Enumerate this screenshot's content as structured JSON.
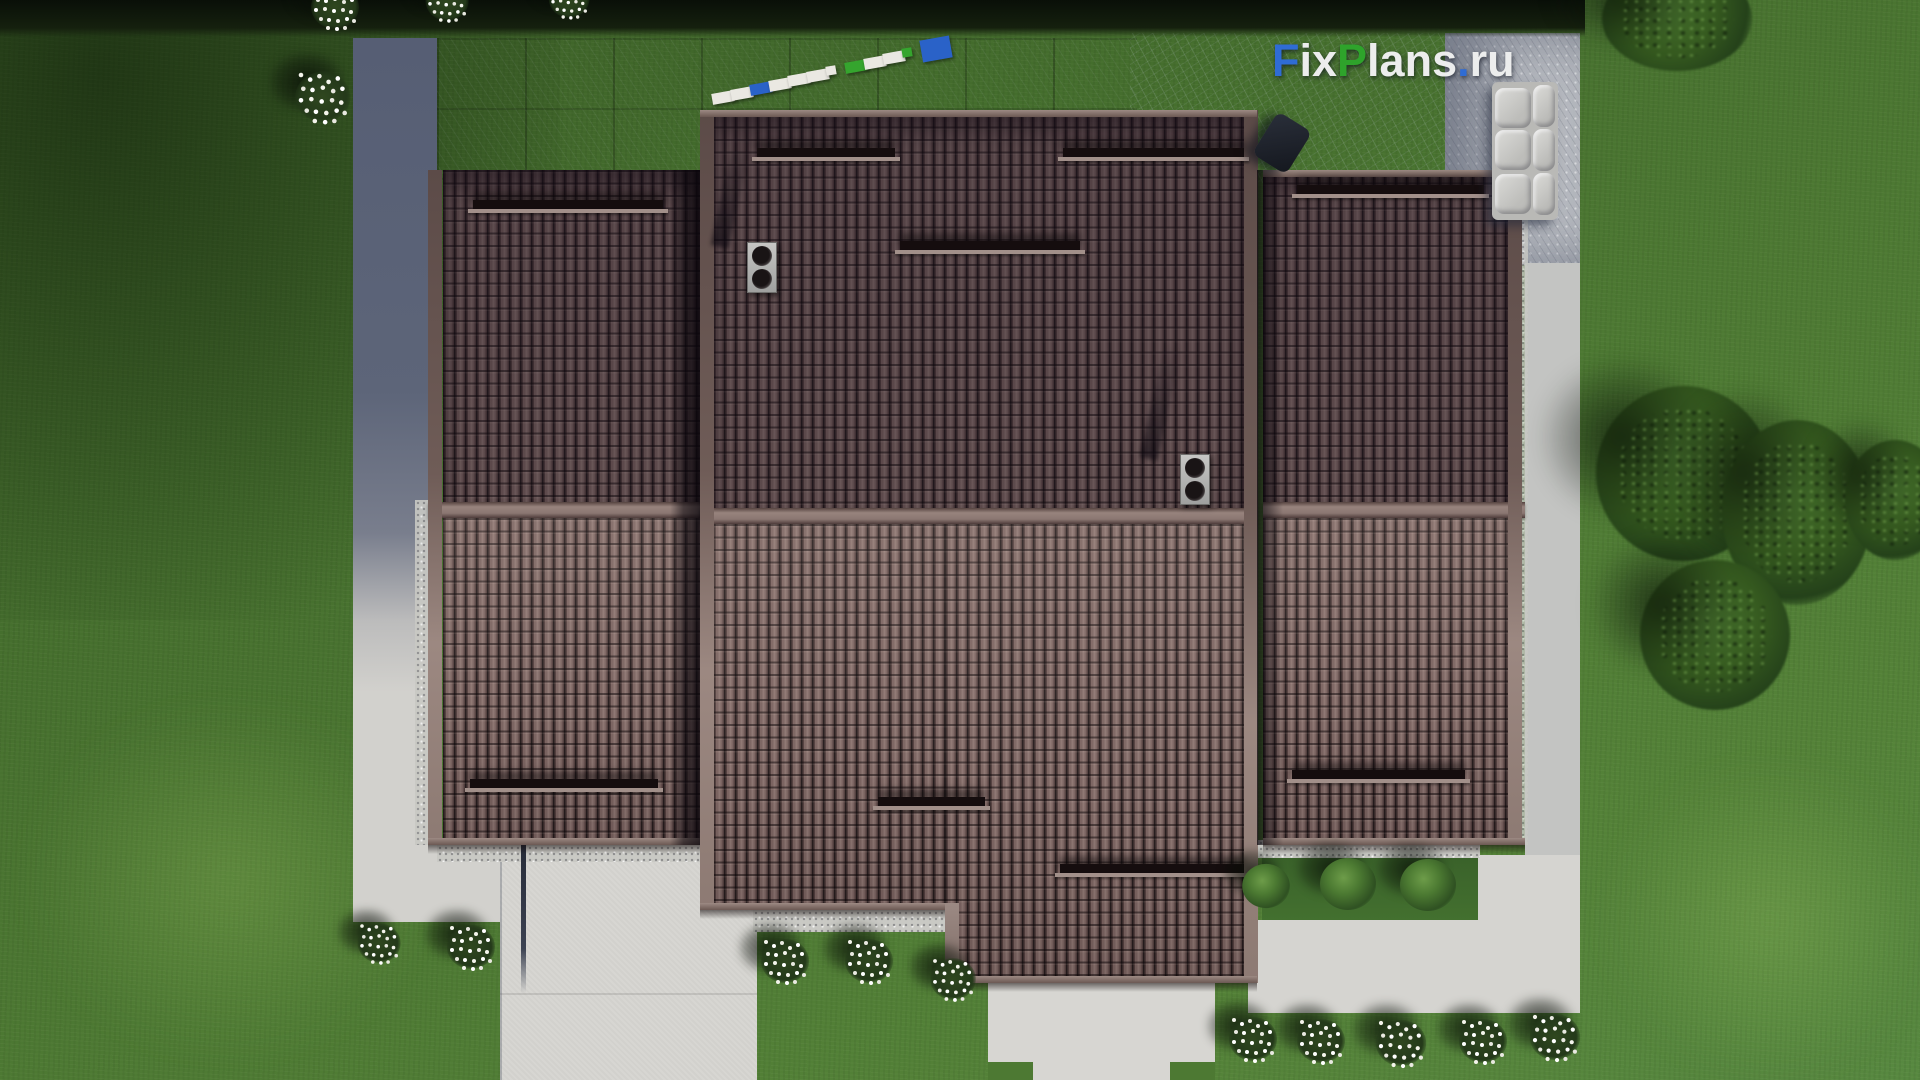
{
  "watermark": {
    "full_text": "FixPlans.ru",
    "segments": [
      {
        "text": "F",
        "color": "#2f6cd4"
      },
      {
        "text": "ix",
        "color": "#eceded"
      },
      {
        "text": "P",
        "color": "#2ea32b"
      },
      {
        "text": "lans",
        "color": "#eceded"
      },
      {
        "text": ".",
        "color": "#2f6cd4"
      },
      {
        "text": "ru",
        "color": "#eceded"
      }
    ]
  },
  "logo_object": {
    "block_colors": [
      "#eae8e2",
      "#eae8e2",
      "#2a62c8",
      "#eae8e2",
      "#eae8e2",
      "#eae8e2",
      "#eae8e2",
      "#35a52e",
      "#eae8e2",
      "#eae8e2",
      "#35a52e",
      "#2a62c8"
    ]
  },
  "palette": {
    "grass": "#4c7a33",
    "grass_dark": "#2e4a20",
    "roof_tile_light": "#8d7672",
    "roof_tile_dark": "#3a2c2c",
    "roof_ridge": "#8d7b75",
    "pavement_shadow": "#59617a",
    "pavement_light": "#d6d5d1",
    "slate_patio": "#39414f",
    "stone_light": "#b8bbbf",
    "foliage": "#33521f",
    "flowers": "#f2f2ea"
  }
}
